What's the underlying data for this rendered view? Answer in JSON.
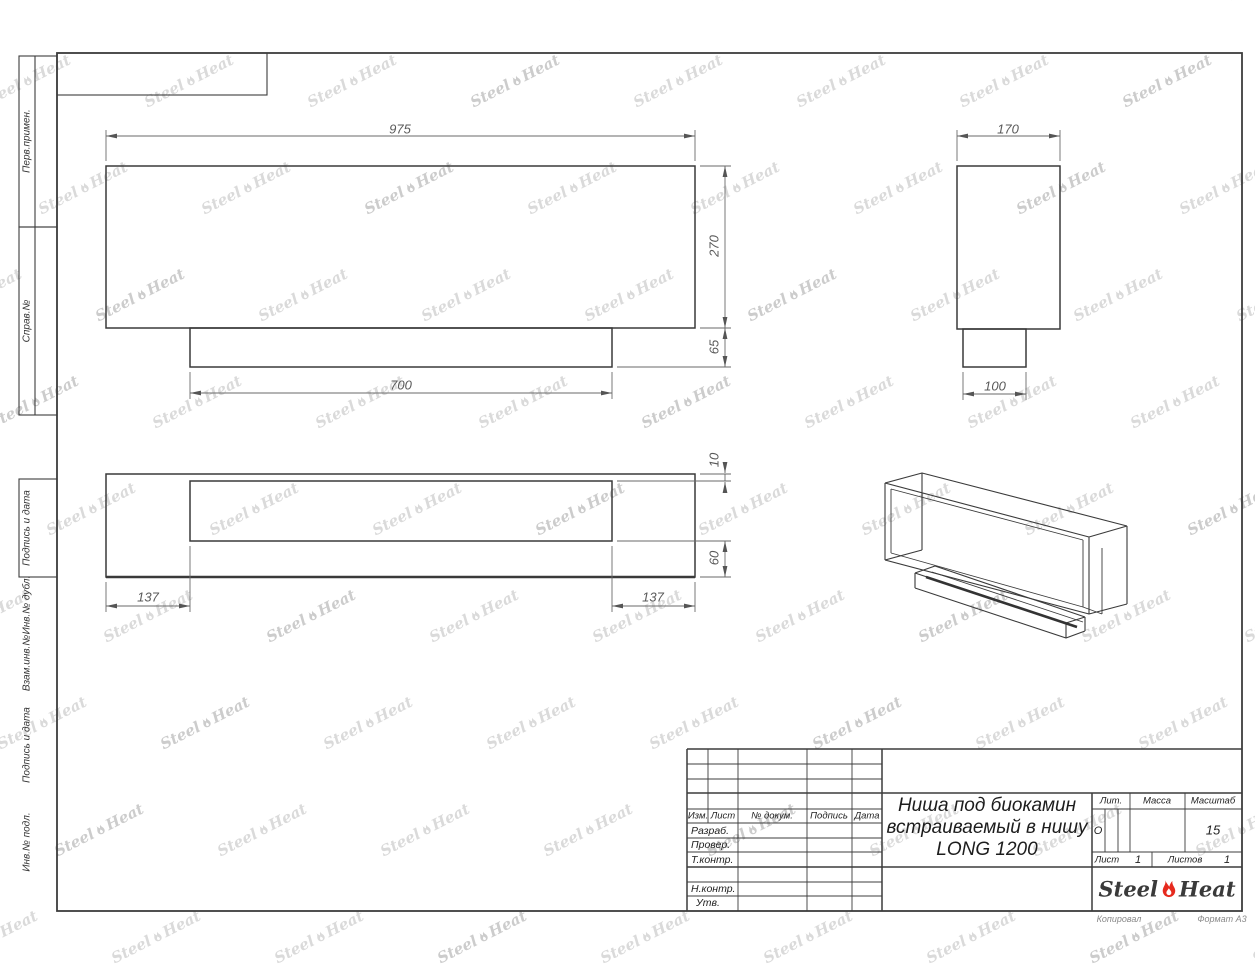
{
  "margin_boxes": [
    {
      "label": "Перв.примен."
    },
    {
      "label": "Справ.№"
    },
    {
      "label": "Подпись и дата"
    },
    {
      "label": "Инв.№ дубл."
    },
    {
      "label": "Взам.инв.№"
    },
    {
      "label": "Подпись и дата"
    },
    {
      "label": "Инв.№ подл."
    }
  ],
  "views": {
    "front": {
      "width": "975",
      "height": "270",
      "base_height": "65",
      "base_width": "700"
    },
    "side": {
      "width": "170",
      "base_width": "100"
    },
    "plan": {
      "inset": "10",
      "back_depth": "60",
      "offset_left": "137",
      "offset_right": "137"
    }
  },
  "title_block": {
    "columns": {
      "izm": "Изм.",
      "list": "Лист",
      "doc": "№ докум.",
      "sign": "Подпись",
      "date": "Дата"
    },
    "rows": {
      "razrab": "Разраб.",
      "prover": "Провер.",
      "tkontr": "Т.контр.",
      "nkontr": "Н.контр.",
      "utv": "Утв."
    },
    "title_line1": "Ниша под биокамин",
    "title_line2": "встраиваемый в нишу",
    "title_line3": "LONG 1200",
    "lit_label": "Лит.",
    "lit_value": "О",
    "mass_label": "Масса",
    "scale_label": "Масштаб",
    "scale_value": "15",
    "sheet_label": "Лист",
    "sheet_value": "1",
    "sheets_label": "Листов",
    "sheets_value": "1",
    "logo_left": "Steel",
    "logo_right": "Heat"
  },
  "footer": {
    "left": "Копировал",
    "right": "Формат А3"
  },
  "watermark": {
    "left": "Steel",
    "right": "Heat"
  },
  "colors": {
    "flame_red": "#e62a1e",
    "line": "#3c3c3c",
    "watermark": "#dadada"
  }
}
